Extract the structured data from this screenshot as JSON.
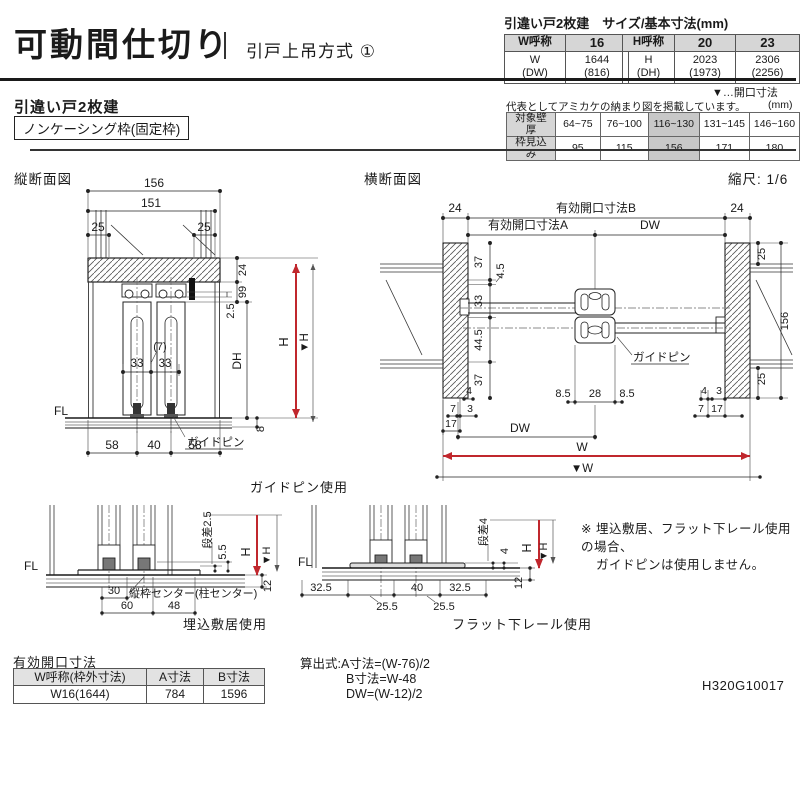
{
  "colors": {
    "accent_red": "#c0272d",
    "header_gray": "#d6d6d6",
    "highlight_gray": "#c8c8c8"
  },
  "header": {
    "title": "可動間仕切り",
    "subtitle": "引戸上吊方式 ①",
    "size_table": {
      "title": "引違い戸2枚建　サイズ/基本寸法(mm)",
      "w_head": "W呼称",
      "w_col": "16",
      "w_label_1": "W",
      "w_label_2": "(DW)",
      "w_val_1": "1644",
      "w_val_2": "(816)",
      "h_head": "H呼称",
      "h_col_1": "20",
      "h_col_2": "23",
      "h_label_1": "H",
      "h_label_2": "(DH)",
      "h20_1": "2023",
      "h20_2": "(1973)",
      "h23_1": "2306",
      "h23_2": "(2256)"
    },
    "opening_legend": "▼…開口寸法"
  },
  "subheader": {
    "product": "引違い戸2枚建",
    "frame_type": "ノンケーシング枠(固定枠)"
  },
  "wall_table": {
    "note": "代表としてアミカケの納まり図を掲載しています。",
    "unit": "(mm)",
    "row1_label": "対象壁厚",
    "row1": [
      "64~75",
      "76~100",
      "116~130",
      "131~145",
      "146~160"
    ],
    "row2_label": "枠見込み",
    "row2": [
      "95",
      "115",
      "156",
      "171",
      "180"
    ]
  },
  "vs": {
    "label": "縦断面図",
    "caption": "ガイドピン使用",
    "d156": "156",
    "d151": "151",
    "d25": "25",
    "d24": "24",
    "d99": "99",
    "d2_5": "2.5",
    "dh": "DH",
    "h": "H",
    "vh": "▼H",
    "d8": "8",
    "d7": "(7)",
    "d33": "33",
    "fl": "FL",
    "pin": "ガイドピン",
    "d58": "58",
    "d40": "40"
  },
  "hs": {
    "label": "横断面図",
    "scale": "縮尺: 1/6",
    "d24": "24",
    "openB": "有効開口寸法B",
    "openA": "有効開口寸法A",
    "dw": "DW",
    "d37": "37",
    "d4_5": "4.5",
    "d33": "33",
    "d44_5": "44.5",
    "d4": "4",
    "d7": "7",
    "d3": "3",
    "d17": "17",
    "d8_5": "8.5",
    "d28": "28",
    "pin": "ガイドピン",
    "d25": "25",
    "d156": "156",
    "w": "W",
    "vw": "▼W"
  },
  "sill": {
    "fl": "FL",
    "step": "段差2.5",
    "d5_5": "5.5",
    "h": "H",
    "vh": "▼H",
    "d12": "12",
    "d30": "30",
    "center_note": "縦枠センター(柱センター)",
    "d60": "60",
    "d48": "48",
    "caption": "埋込敷居使用"
  },
  "rail": {
    "fl": "FL",
    "step": "段差4",
    "d4": "4",
    "h": "H",
    "vh": "▼H",
    "d12": "12",
    "d32_5": "32.5",
    "d40": "40",
    "d25_5": "25.5",
    "caption": "フラット下レール使用"
  },
  "note": {
    "line1": "※ 埋込敷居、フラット下レール使用の場合、",
    "line2": "ガイドピンは使用しません。"
  },
  "opening_table": {
    "title": "有効開口寸法",
    "h1": "W呼称(枠外寸法)",
    "h2": "A寸法",
    "h3": "B寸法",
    "c1": "W16(1644)",
    "c2": "784",
    "c3": "1596"
  },
  "formula": {
    "line1": "算出式:A寸法=(W-76)/2",
    "line2": "B寸法=W-48",
    "line3": "DW=(W-12)/2"
  },
  "doc_code": "H320G10017"
}
